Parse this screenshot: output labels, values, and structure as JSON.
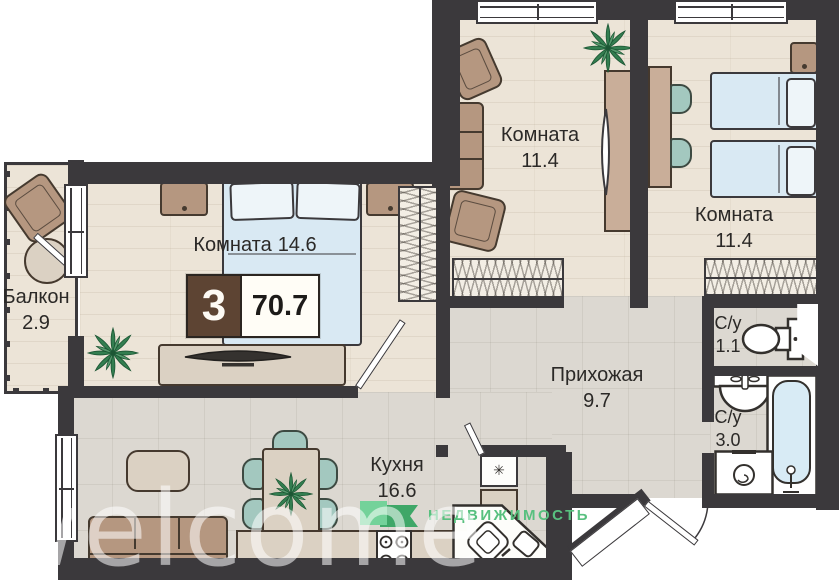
{
  "badge": {
    "rooms": "3",
    "area": "70.7"
  },
  "rooms": {
    "balcony": {
      "name": "Балкон",
      "area": "2.9"
    },
    "bedroom": {
      "name": "Комната",
      "area": "14.6"
    },
    "room_top_middle": {
      "name": "Комната",
      "area": "11.4"
    },
    "room_top_right": {
      "name": "Комната",
      "area": "11.4"
    },
    "hallway": {
      "name": "Прихожая",
      "area": "9.7"
    },
    "kitchen": {
      "name": "Кухня",
      "area": "16.6"
    },
    "wc_small": {
      "name": "С/у",
      "area": "1.1"
    },
    "wc_big": {
      "name": "С/у",
      "area": "3.0"
    }
  },
  "brand": {
    "logo_text": "НЕДВИЖИМОСТЬ"
  },
  "watermark": "welcome",
  "symbols": {
    "fridge": "✳"
  },
  "colors": {
    "wall": "#3b393c",
    "accent_green": "#58c07f",
    "badge_brown": "#5d4433",
    "bed_blue": "#d9e9f3",
    "furniture_brown": "#b59780",
    "chair_teal": "#a3c8bf"
  }
}
